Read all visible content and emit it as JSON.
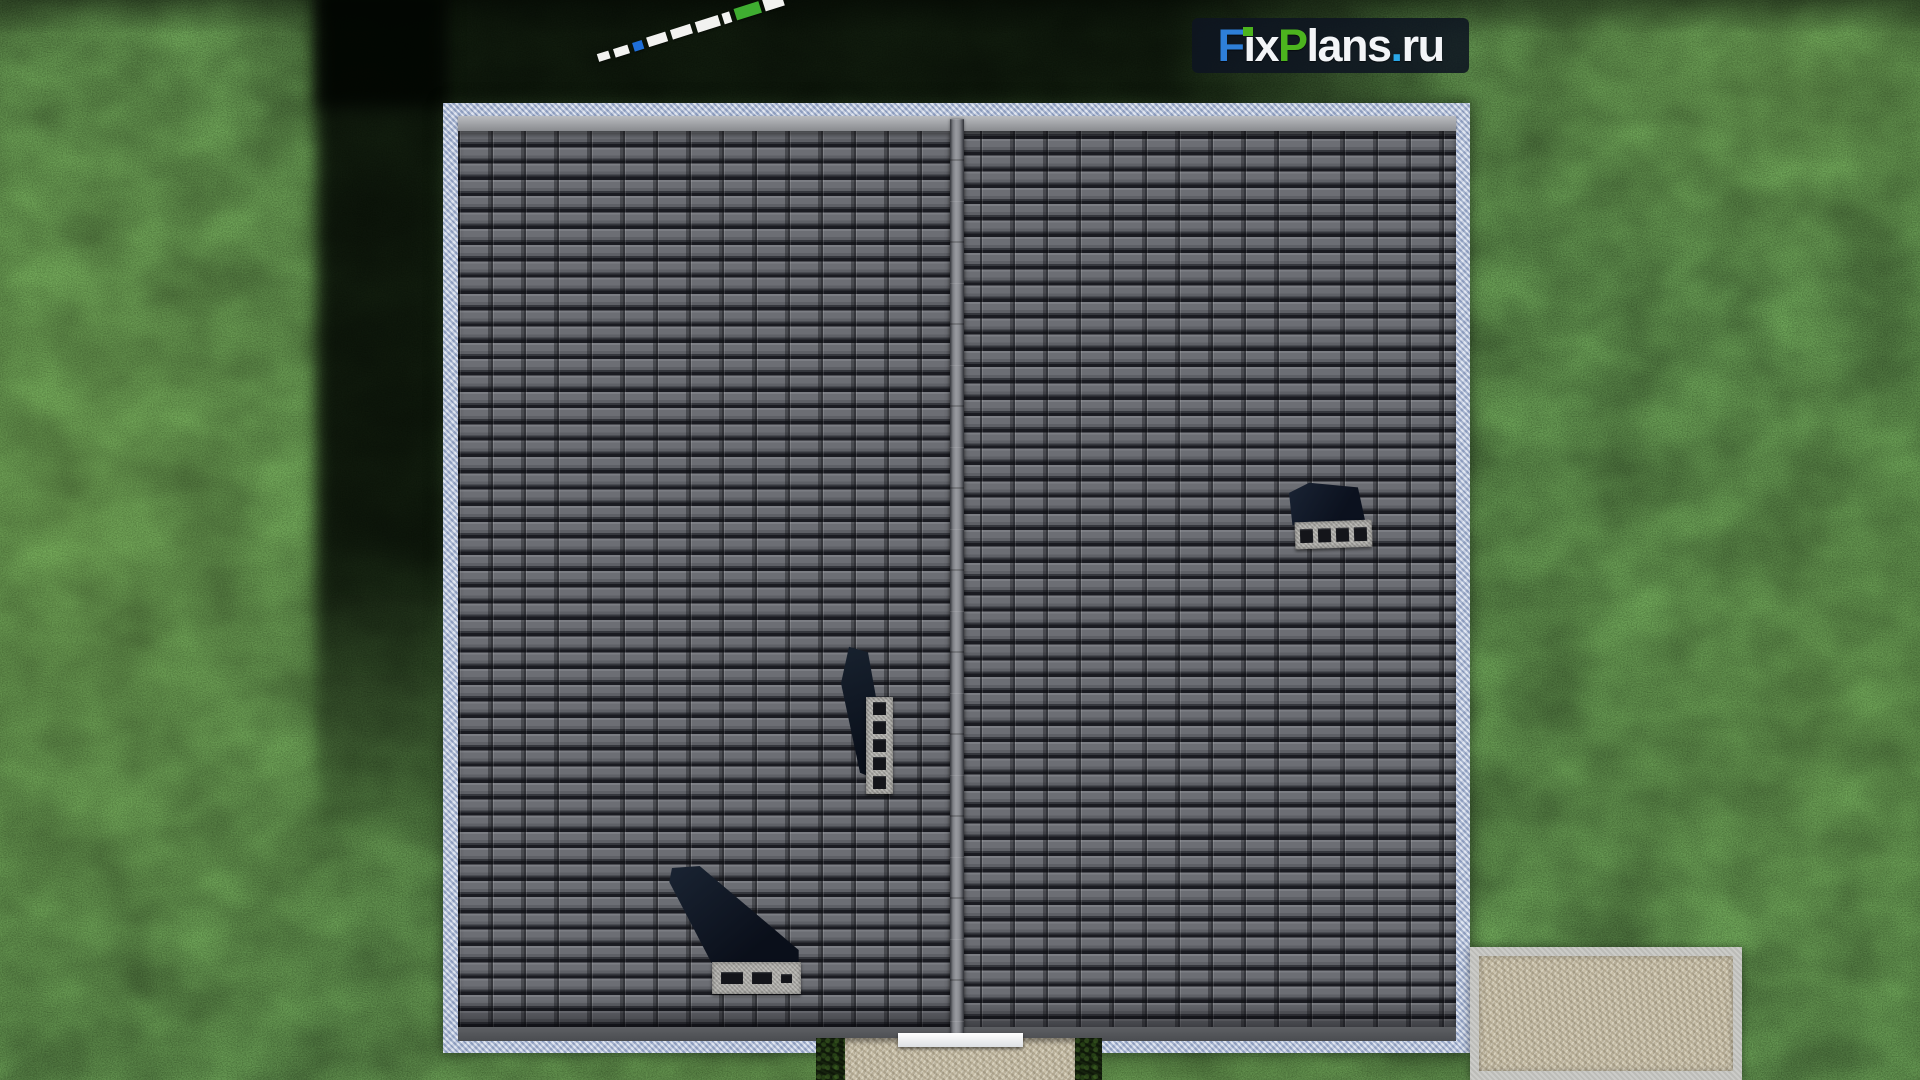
{
  "watermark": {
    "site_name": "FixPlans.ru",
    "parts": [
      {
        "text": "F",
        "color": "#2e7fd9"
      },
      {
        "text": "i",
        "color": "#f3f5f8",
        "dot_color": "#4cb41e"
      },
      {
        "text": "x",
        "color": "#f3f5f8"
      },
      {
        "text": "P",
        "color": "#4cb41e"
      },
      {
        "text": "lans",
        "color": "#f3f5f8"
      },
      {
        "text": ".",
        "color": "#2aa7e8"
      },
      {
        "text": "ru",
        "color": "#f3f5f8"
      }
    ],
    "plate_color": "#0e1421"
  },
  "scene": {
    "view": "top-down 3d render of gable roof on lawn",
    "lawn": {
      "base_color": "#31451c",
      "shadow_color": "#020502"
    },
    "roof": {
      "tile_color": "#63656b",
      "tile_gap_color": "#1a1b21",
      "ridge_color": "#8b8d93",
      "ridge_orientation": "vertical-center",
      "eave_top_color": "#a9abaf",
      "eave_bottom_color": "#54565a",
      "gravel_border_color": "#b9c4d9"
    },
    "chimneys": {
      "count": 3,
      "cap_color": "#b3b2ae",
      "flue_hole_color": "#14151a",
      "shadow_color": "#0d1422",
      "flue_counts": [
        4,
        5,
        3
      ]
    },
    "terrace": {
      "paving_color": "#c6bda6",
      "frame_color": "#c8c8c4"
    },
    "path": {
      "paving_color": "#c6bda6"
    },
    "entrance_step": {
      "color": "#f2f3f5"
    },
    "bushes": {
      "count": 2,
      "color": "#16230e"
    },
    "marker_line": {
      "style": "diagonal dashed line",
      "segment_colors": [
        "#f2f2f0",
        "#1f6fd8",
        "#3fae31"
      ]
    }
  }
}
